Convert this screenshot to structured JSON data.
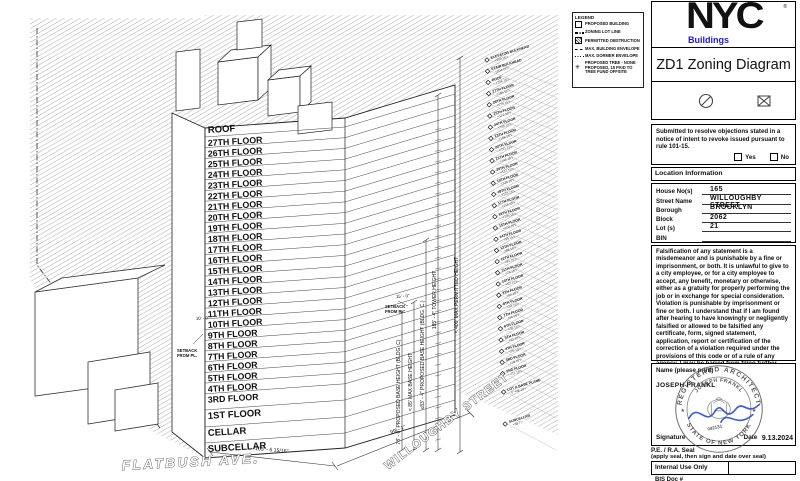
{
  "colors": {
    "brand_blue": "#1e18c8",
    "signature_blue": "#2f4fc0",
    "seal_gray": "#555555",
    "line": "#111111"
  },
  "legend": {
    "title": "LEGEND",
    "items": [
      {
        "icon": "square-outline",
        "label": "PROPOSED BUILDING"
      },
      {
        "icon": "dash-dot-line",
        "label": "ZONING LOT LINE"
      },
      {
        "icon": "hatched-square",
        "label": "PERMITTED OBSTRUCTION"
      },
      {
        "icon": "dashed-line",
        "label": "MAX. BUILDING ENVELOPE"
      },
      {
        "icon": "dotted-line",
        "label": "MAX. DORMER ENVELOPE"
      },
      {
        "icon": "tree",
        "label": "PROPOSED TREE - NONE PROPOSED, 15 PAID TO TREE FUND OFFSITE"
      }
    ]
  },
  "form": {
    "logo": {
      "brand": "NYC",
      "registered": "®",
      "sub": "Buildings"
    },
    "title": "ZD1 Zoning Diagram",
    "objections": {
      "text": "Submitted to resolve objections stated in a notice of intent to revoke issued pursuant to rule 101-15.",
      "yes_label": "Yes",
      "no_label": "No"
    },
    "location": {
      "header": "Location Information",
      "fields": [
        {
          "label": "House No(s)",
          "value": "165"
        },
        {
          "label": "Street Name",
          "value": "WILLOUGHBY STREET"
        },
        {
          "label": "Borough",
          "value": "BROOKLYN"
        },
        {
          "label": "Block",
          "value": "2062"
        },
        {
          "label": "Lot (s)",
          "value": "21"
        },
        {
          "label": "BIN",
          "value": ""
        }
      ]
    },
    "falsification": "Falsification of any statement is a misdemeanor and is punishable by a fine or imprisonment, or both. It is unlawful to give to a city employee, or for a city employee to accept, any benefit, monetary or otherwise, either as a gratuity for properly performing the job or in exchange for special consideration. Violation is punishable by imprisonment or fine or both. I understand that if I am found after hearing to have knowingly or negligently falsified or allowed to be falsified any certificate, form, signed statement, application, report or certification of the correction of a violation required under the provisions of this code or of a rule of any agency, I may be barred from filing further applications of documents with the Department.",
    "signature": {
      "name_label": "Name (please print)",
      "name_value": "JOSEPH FRANKL",
      "signature_label": "Signature",
      "date_label": "Date",
      "date_value": "9.13.2024",
      "seal_note_line1": "P.E. / R.A. Seal",
      "seal_note_line2": "(apply seal, then sign and date over seal)",
      "seal": {
        "arc_top": "REGISTERED ARCHITECT",
        "arc_name": "JOSEPH FRANKL",
        "arc_bottom": "STATE OF NEW YORK",
        "number": "042131"
      }
    },
    "internal_use": "Internal Use Only",
    "bis_doc": "BIS Doc #"
  },
  "drawing": {
    "floors": [
      "ROOF",
      "27TH FLOOR",
      "26TH FLOOR",
      "25TH FLOOR",
      "24TH FLOOR",
      "23TH FLOOR",
      "22TH FLOOR",
      "21TH FLOOR",
      "20TH FLOOR",
      "19TH FLOOR",
      "18TH FLOOR",
      "17TH FLOOR",
      "16TH FLOOR",
      "15TH FLOOR",
      "14TH FLOOR",
      "13TH FLOOR",
      "12TH FLOOR",
      "11TH FLOOR",
      "10TH FLOOR",
      "9TH FLOOR",
      "8TH FLOOR",
      "7TH FLOOR",
      "6TH FLOOR",
      "5TH FLOOR",
      "4TH FLOOR",
      "3RD FLOOR",
      "1ST FLOOR",
      "CELLAR",
      "SUBCELLAR"
    ],
    "vertical_dims": [
      "78' - 0\" PROPOSED BASE HEIGHT (BLDG. C)",
      "< 85' MAX BASE HEIGHT",
      "≤83' - 4\" PROPOSED BASE HEIGHT (BLDG. C.)",
      "185' - 4\" TOWER HEIGHT",
      "< 400' MAX PERMITTED HEIGHT"
    ],
    "width_dim": "103' - 6 15/16\"",
    "depth_dim": "99' - 1\"",
    "setback_left": {
      "dim": "10' - 0\"",
      "label": "SETBACK FROM PL."
    },
    "setback_right": {
      "dim": "15' - 0\"",
      "label": "SETBACK FROM PL."
    },
    "street_left": "FLATBUSH AVE.",
    "street_right": "WILLOUGHBY STREET",
    "elevation_markers": [
      {
        "name": "ELEVATOR BULKHEAD",
        "elev": "<209.15'>"
      },
      {
        "name": "STAIR BULKHEAD",
        "elev": "<204.15'>"
      },
      {
        "name": "ROOF",
        "elev": "<196.15'>"
      },
      {
        "name": "27TH FLOOR",
        "elev": "<186.15'>"
      },
      {
        "name": "26TH FLOOR",
        "elev": "<179.15'>"
      },
      {
        "name": "25TH FLOOR",
        "elev": "<172.15'>"
      },
      {
        "name": "24TH FLOOR",
        "elev": "<165.15'>"
      },
      {
        "name": "23TH FLOOR",
        "elev": "<158.15'>"
      },
      {
        "name": "22TH FLOOR",
        "elev": "<151.15'>"
      },
      {
        "name": "21TH FLOOR",
        "elev": "<144.15'>"
      },
      {
        "name": "20TH FLOOR",
        "elev": "<137.15'>"
      },
      {
        "name": "19TH FLOOR",
        "elev": "<130.15'>"
      },
      {
        "name": "18TH FLOOR",
        "elev": "<123.15'>"
      },
      {
        "name": "17TH FLOOR",
        "elev": "<116.15'>"
      },
      {
        "name": "16TH FLOOR",
        "elev": "<109.15'>"
      },
      {
        "name": "15TH FLOOR",
        "elev": "<102.15'>"
      },
      {
        "name": "14TH FLOOR",
        "elev": "<95.15'>"
      },
      {
        "name": "13TH FLOOR",
        "elev": "<88.15'>"
      },
      {
        "name": "12TH FLOOR",
        "elev": "<81.15'>"
      },
      {
        "name": "11TH FLOOR",
        "elev": "<74.15'>"
      },
      {
        "name": "10TH FLOOR",
        "elev": "<67.15'>"
      },
      {
        "name": "9TH FLOOR",
        "elev": "<60.15'>"
      },
      {
        "name": "8TH FLOOR",
        "elev": "<53.15'>"
      },
      {
        "name": "7TH FLOOR",
        "elev": "<46.15'>"
      },
      {
        "name": "6TH FLOOR",
        "elev": "<39.15'>"
      },
      {
        "name": "5TH FLOOR",
        "elev": "<32.15'>"
      },
      {
        "name": "4TH FLOOR",
        "elev": "<25.15'>"
      },
      {
        "name": "3RD FLOOR",
        "elev": "<18.15'>"
      },
      {
        "name": "2ND FLOOR",
        "elev": "<11.15'>"
      },
      {
        "name": "LOT A BASE PLANE",
        "elev": "0' <48.13'>"
      },
      {
        "name": "SUBCELLAR",
        "elev": "<38.7'>"
      }
    ]
  }
}
